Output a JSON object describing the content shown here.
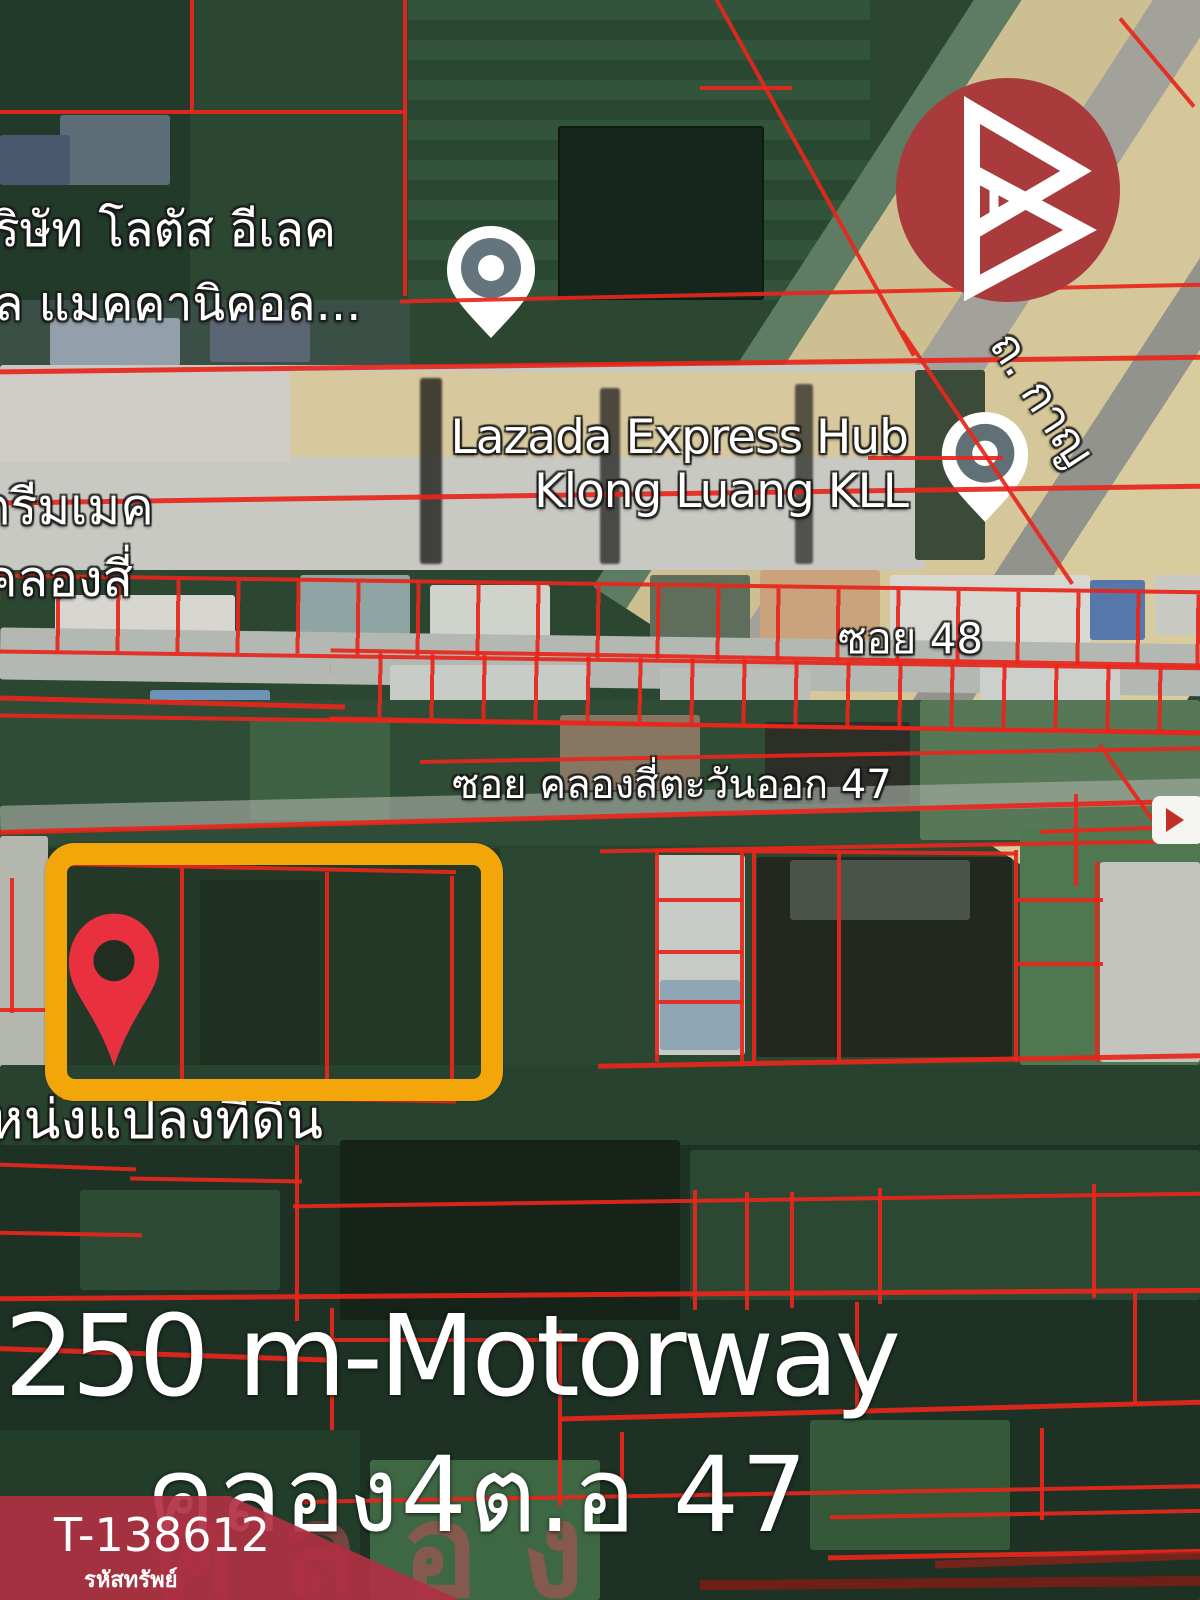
{
  "map": {
    "labels": {
      "company_line1": "ริษัท โลตัส อีเลค",
      "company_line2": "ล แมคคานิคอล...",
      "lazada_line1": "Lazada Express Hub",
      "lazada_line2": "Klong Luang KLL",
      "dream_line1": "ดรีมเมค",
      "dream_line2": "คลองสี่",
      "soi_48": "ซอย 48",
      "soi_47": "ซอย คลองสี่ตะวันออก 47",
      "road_right": "ถ. กาญ",
      "plot": "หน่งแปลงที่ดิน",
      "watermark": "คลอง"
    },
    "annotations": {
      "distance": "250 m-Motorway",
      "location": "คลอง4ต.อ 47"
    },
    "badge": {
      "property_id": "T-138612",
      "caption": "รหัสทรัพย์"
    },
    "colors": {
      "parcel_line": "#e8261c",
      "highlight_box": "#f2a60a",
      "location_pin": "#e8303f",
      "brand_circle": "#a93b3c",
      "badge_red": "#b13349"
    }
  }
}
